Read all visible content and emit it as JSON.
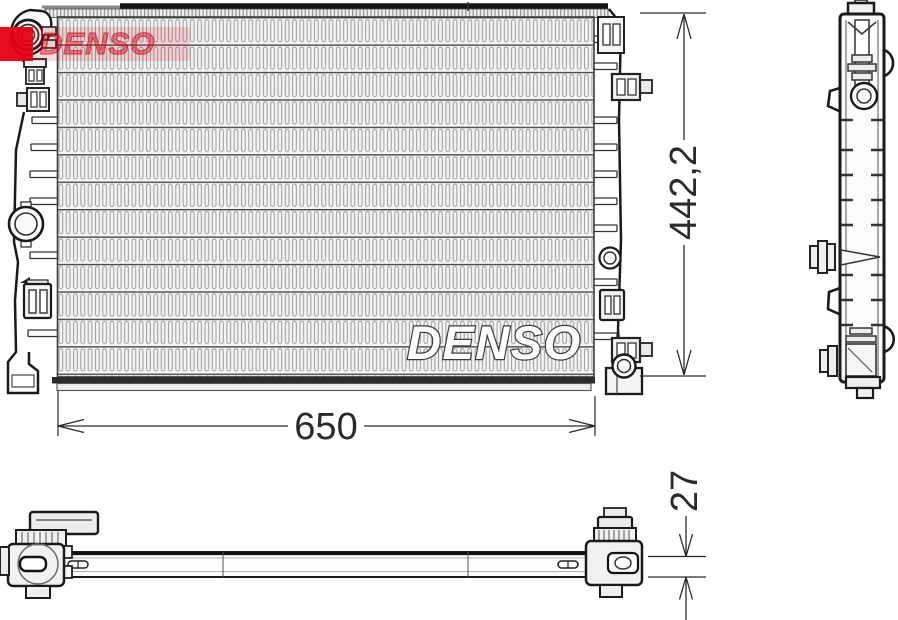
{
  "dimensions": {
    "height": "442,2",
    "width": "650",
    "depth": "27"
  },
  "watermarks": {
    "core_text": "DENSO",
    "logo_text": "DENSO"
  },
  "colors": {
    "background": "#ffffff",
    "line": "#1a1a1a",
    "fin_gray": "#9b9b9b",
    "logo_red": "#e60012"
  }
}
